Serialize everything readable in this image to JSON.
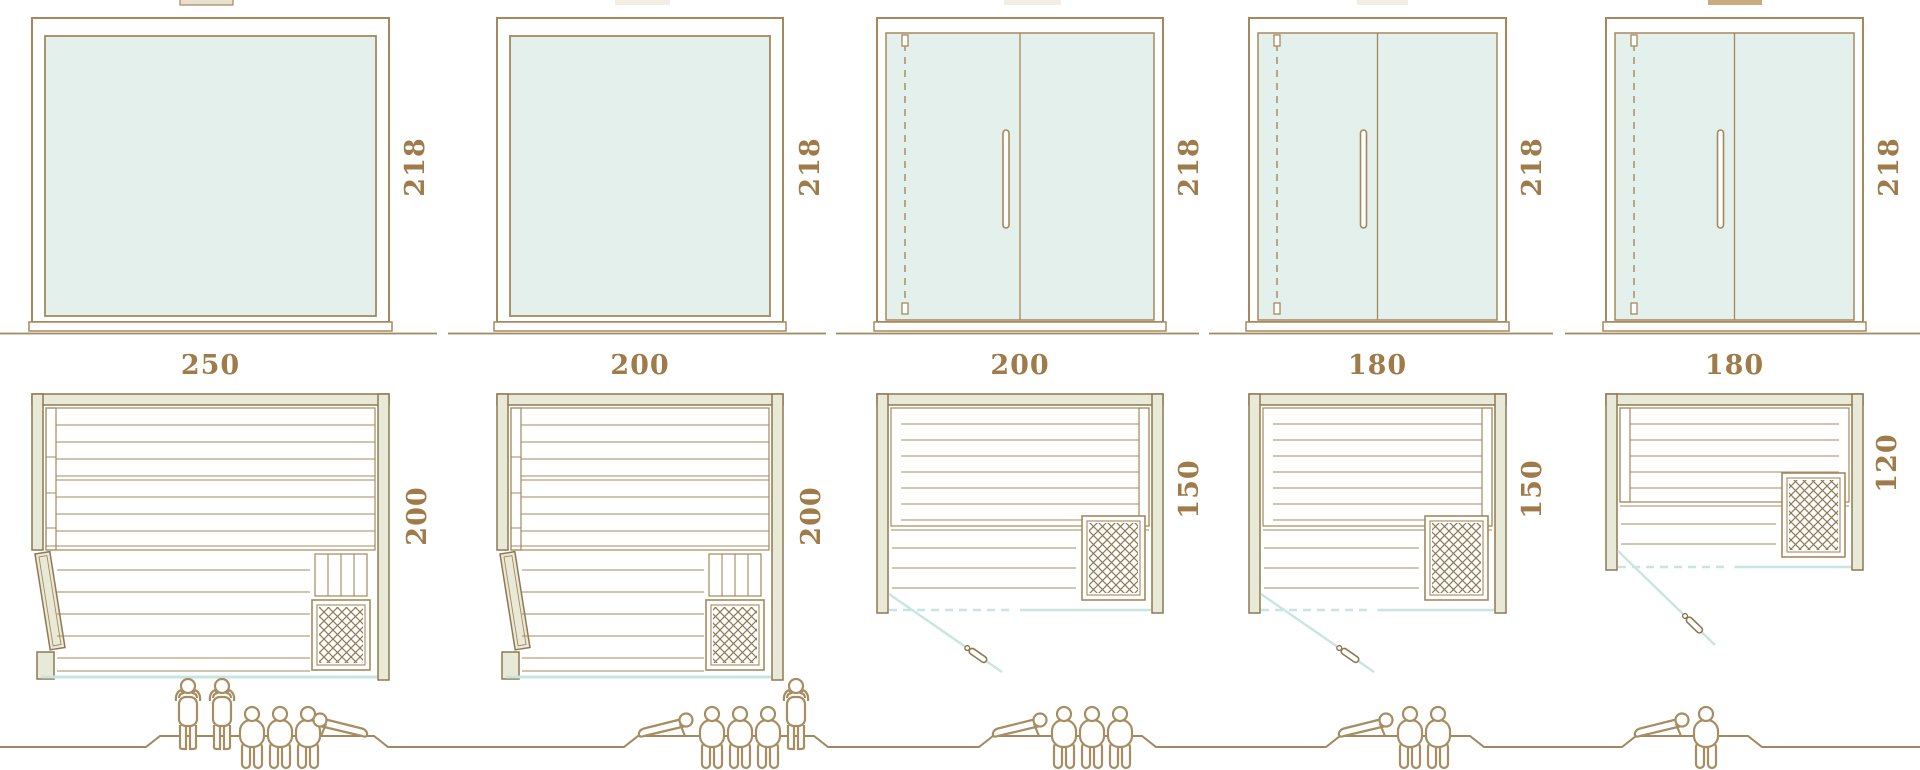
{
  "diagram": {
    "kind": "sauna cabin size comparison, front elevations with plan views and capacity pictograms",
    "ground_line": "stepped baseline with raised platform under each capacity group"
  },
  "colors": {
    "line": "#a6885c",
    "line_dark": "#8d7952",
    "wall_fill": "#e9e9d7",
    "glass_fill": "#e3f0ec",
    "glass_line": "#c9e5e0",
    "text": "#a07b4a",
    "figure": "#a78d62",
    "ground": "#a2885e",
    "tab_light": "#f3eee4",
    "tab_mid": "#e8e0d0",
    "tab_dark": "#c9ab7f",
    "white": "#ffffff"
  },
  "icons": [
    {
      "name": "standing-person-icon"
    },
    {
      "name": "sitting-person-icon"
    },
    {
      "name": "lying-person-icon"
    },
    {
      "name": "heater-lattice-icon"
    },
    {
      "name": "door-handle-icon"
    }
  ],
  "units": [
    {
      "name": "sauna-250x200",
      "height_label": "218",
      "width_label": "250",
      "depth_label": "200",
      "dimensions_cm": {
        "width": 250,
        "depth": 200,
        "height": 218
      },
      "front_type": "fixed-glass-panel",
      "door_type": "hinged-wood-door-left-wall",
      "capacity": {
        "standing": 2,
        "sitting": 3,
        "lying": 1,
        "total": 6
      },
      "figures": [
        "standing",
        "standing",
        "sitting",
        "sitting",
        "sitting",
        "lying_r"
      ]
    },
    {
      "name": "sauna-200x200",
      "height_label": "218",
      "width_label": "200",
      "depth_label": "200",
      "dimensions_cm": {
        "width": 200,
        "depth": 200,
        "height": 218
      },
      "front_type": "fixed-glass-panel",
      "door_type": "hinged-wood-door-left-wall",
      "capacity": {
        "standing": 1,
        "sitting": 3,
        "lying": 1,
        "total": 5
      },
      "figures": [
        "lying_l",
        "sitting",
        "sitting",
        "sitting",
        "standing"
      ]
    },
    {
      "name": "sauna-200x150",
      "height_label": "218",
      "width_label": "200",
      "depth_label": "150",
      "dimensions_cm": {
        "width": 200,
        "depth": 150,
        "height": 218
      },
      "front_type": "glass-front-with-door",
      "door_type": "hinged-glass-door-front-left",
      "capacity": {
        "standing": 0,
        "sitting": 3,
        "lying": 1,
        "total": 4
      },
      "figures": [
        "lying_l",
        "sitting",
        "sitting",
        "sitting"
      ]
    },
    {
      "name": "sauna-180x150",
      "height_label": "218",
      "width_label": "180",
      "depth_label": "150",
      "dimensions_cm": {
        "width": 180,
        "depth": 150,
        "height": 218
      },
      "front_type": "glass-front-with-door",
      "door_type": "hinged-glass-door-front-left",
      "capacity": {
        "standing": 0,
        "sitting": 2,
        "lying": 1,
        "total": 3
      },
      "figures": [
        "lying_l",
        "sitting",
        "sitting"
      ]
    },
    {
      "name": "sauna-180x120",
      "height_label": "218",
      "width_label": "180",
      "depth_label": "120",
      "dimensions_cm": {
        "width": 180,
        "depth": 120,
        "height": 218
      },
      "front_type": "glass-front-with-door",
      "door_type": "hinged-glass-door-front-left",
      "capacity": {
        "standing": 0,
        "sitting": 1,
        "lying": 1,
        "total": 2
      },
      "figures": [
        "lying_l",
        "sitting"
      ]
    }
  ]
}
